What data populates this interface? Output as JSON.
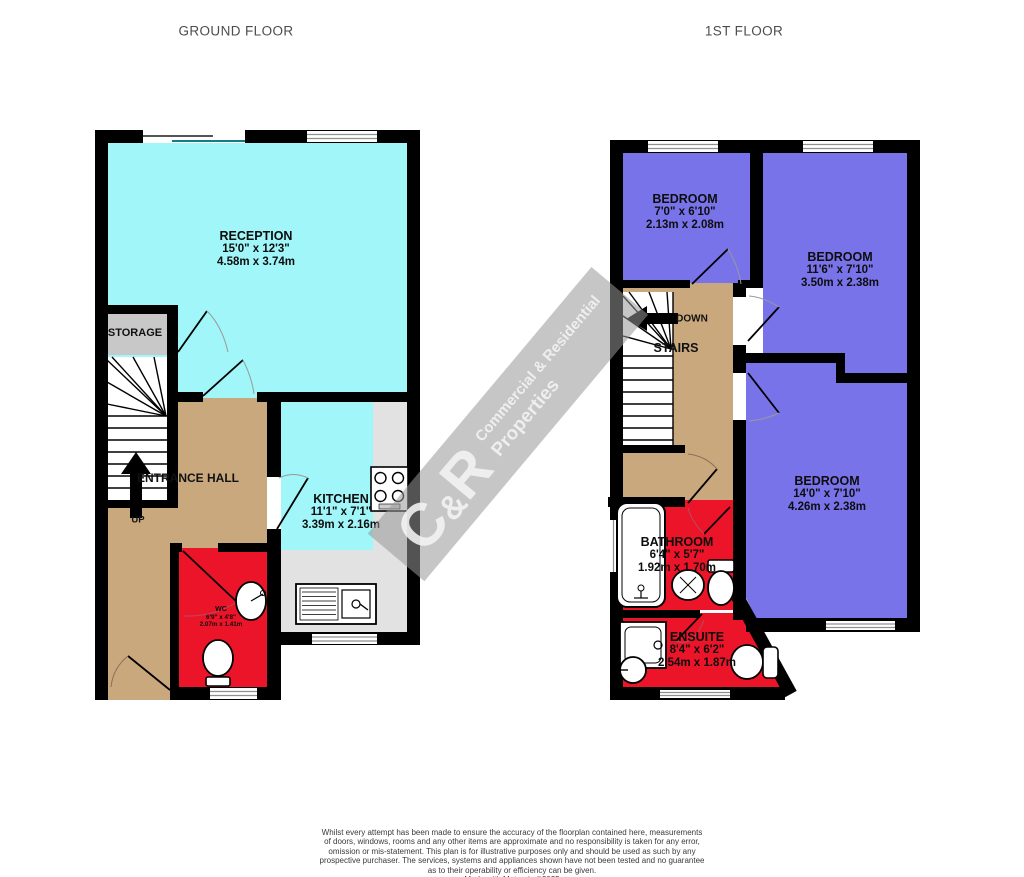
{
  "header": {
    "ground_floor_title": "GROUND FLOOR",
    "first_floor_title": "1ST FLOOR"
  },
  "colors": {
    "room_cyan": "#A0F6F8",
    "room_blue": "#7973EA",
    "room_red": "#EC1428",
    "hall_tan": "#C9A87E",
    "storage_gray": "#C8C8C8",
    "counter_gray": "#E2E2E2",
    "wall_black": "#000000",
    "window_line": "#909090",
    "patio_line": "#177d85",
    "arc_gray": "#999999"
  },
  "ground_floor": {
    "rooms": {
      "reception": {
        "name": "RECEPTION",
        "imperial": "15'0\" x 12'3\"",
        "metric": "4.58m x 3.74m"
      },
      "storage": {
        "name": "STORAGE"
      },
      "entrance_hall": {
        "name": "ENTRANCE HALL"
      },
      "kitchen": {
        "name": "KITCHEN",
        "imperial": "11'1\" x 7'1\"",
        "metric": "3.39m x 2.16m"
      },
      "wc": {
        "name": "WC",
        "imperial": "6'9\" x 4'8\"",
        "metric": "2.07m x 1.41m"
      }
    },
    "stairs": {
      "up_label": "UP"
    }
  },
  "first_floor": {
    "rooms": {
      "bedroom1": {
        "name": "BEDROOM",
        "imperial": "7'0\" x 6'10\"",
        "metric": "2.13m x 2.08m"
      },
      "bedroom2": {
        "name": "BEDROOM",
        "imperial": "11'6\" x 7'10\"",
        "metric": "3.50m x 2.38m"
      },
      "bedroom3": {
        "name": "BEDROOM",
        "imperial": "14'0\" x 7'10\"",
        "metric": "4.26m x 2.38m"
      },
      "bathroom": {
        "name": "BATHROOM",
        "imperial": "6'4\" x 5'7\"",
        "metric": "1.92m x 1.70m"
      },
      "ensuite": {
        "name": "ENSUITE",
        "imperial": "8'4\" x 6'2\"",
        "metric": "2.54m x 1.87m"
      }
    },
    "stairs": {
      "down_label": "DOWN",
      "stairs_label": "STAIRS"
    }
  },
  "watermark": {
    "logo_c": "C",
    "logo_amp": "&",
    "logo_r": "R",
    "line1": "Commercial & Residential",
    "line2": "Properties"
  },
  "disclaimer": {
    "lines": [
      "Whilst every attempt has been made to ensure the accuracy of the floorplan contained here, measurements",
      "of doors, windows, rooms and any other items are approximate and no responsibility is taken for any error,",
      "omission or mis-statement. This plan is for illustrative purposes only and should be used as such by any",
      "prospective purchaser. The services, systems and appliances shown have not been tested and no guarantee",
      "as to their operability or efficiency can be given.",
      "Made with Metropix ©2025"
    ]
  }
}
